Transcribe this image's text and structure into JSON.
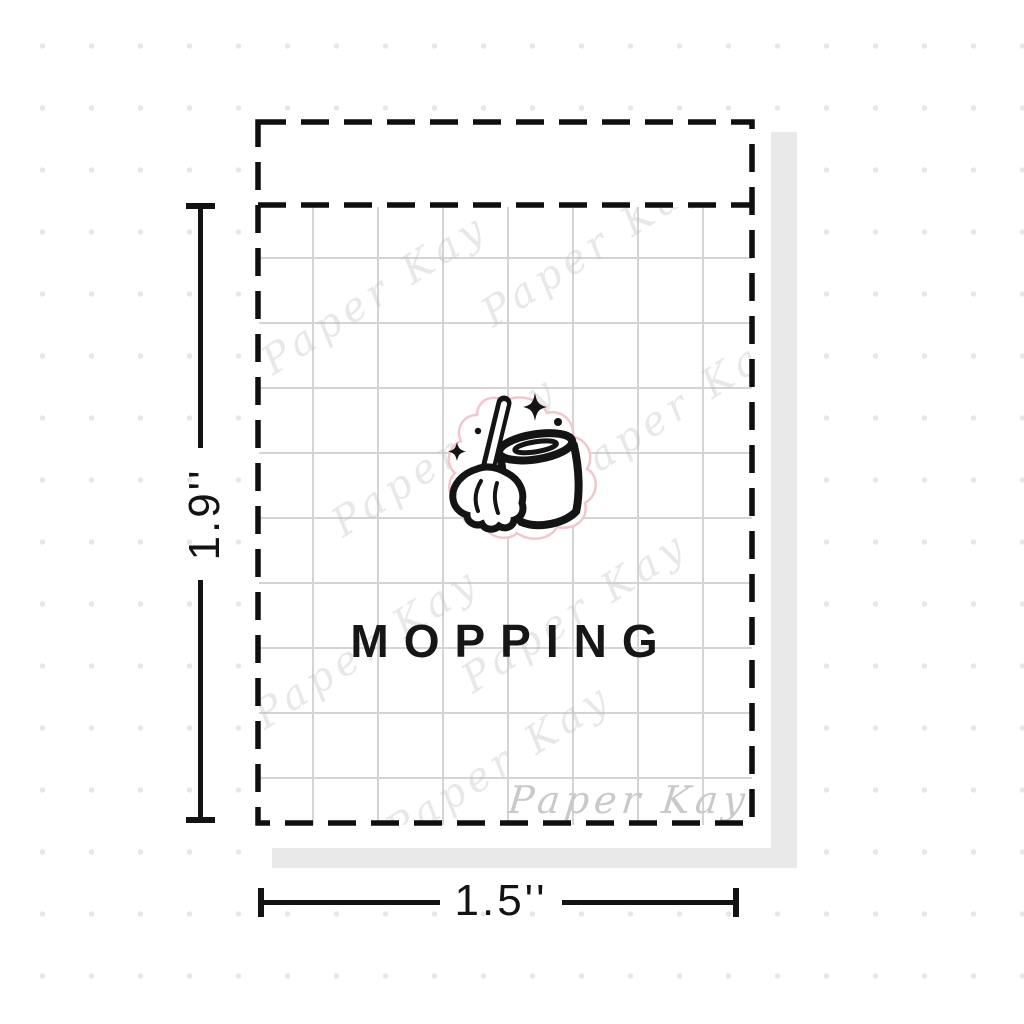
{
  "diagram": {
    "sticker_name": "MOPPING",
    "icon": "mop-and-bucket-with-sparkles",
    "height_label": "1.9''",
    "width_label": "1.5''",
    "brand_watermark": "Paper Kay",
    "colors": {
      "ink": "#141414",
      "grid_line": "#d4d4d4",
      "background_dot": "#e7e7e7",
      "drop_shadow": "#e9e9e9",
      "diecut_outline": "#f2c6cd",
      "watermark_gray": "#c9c9c9"
    }
  }
}
